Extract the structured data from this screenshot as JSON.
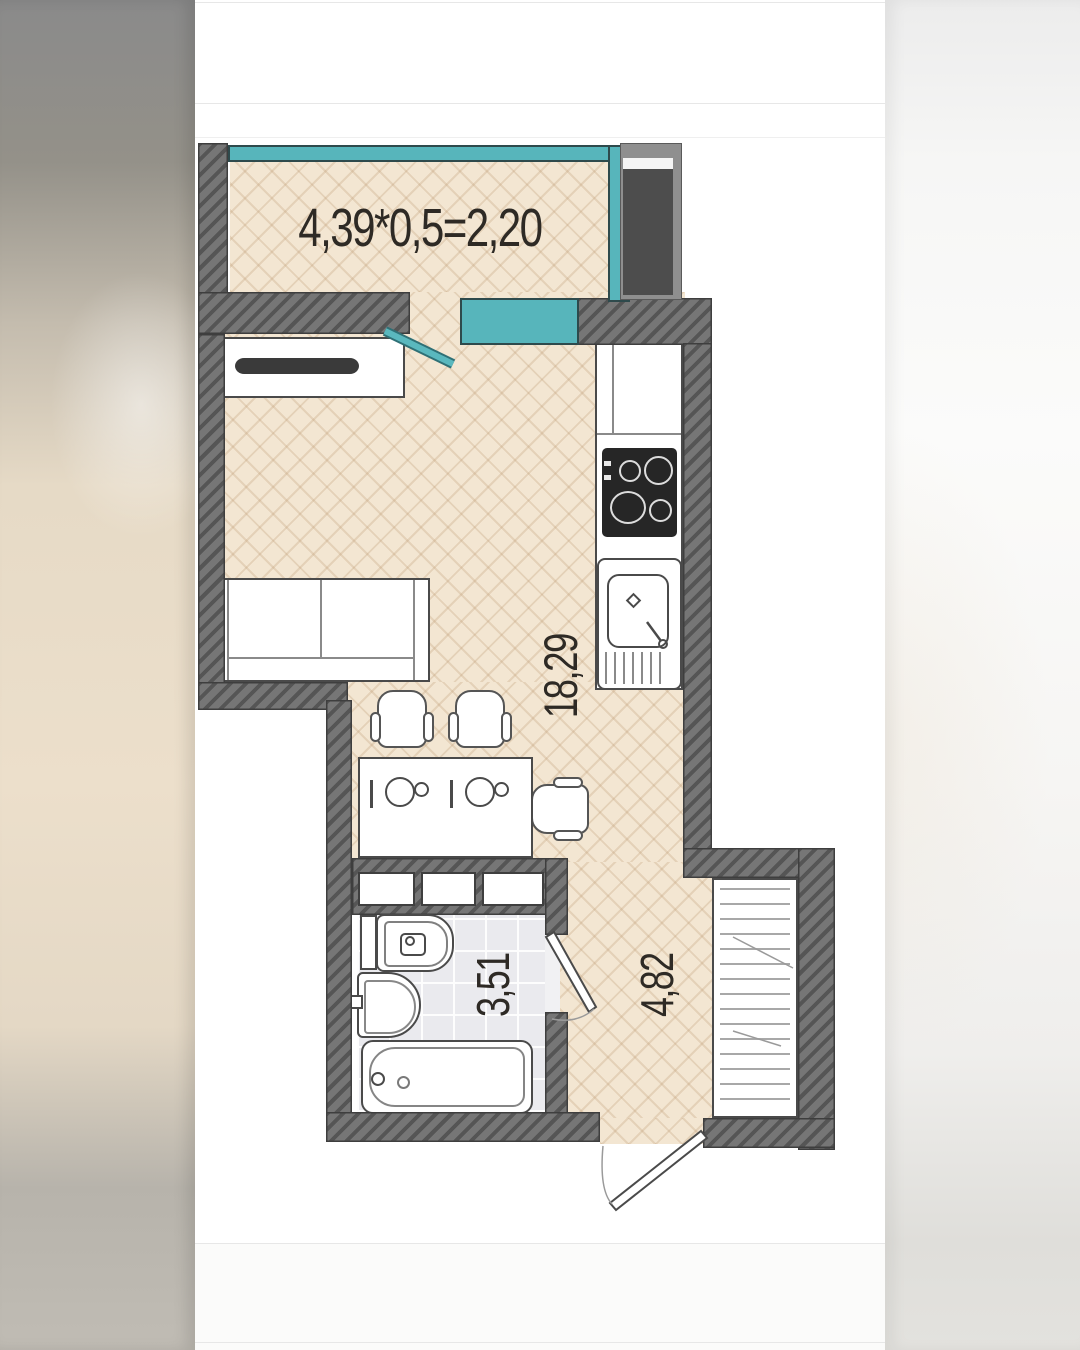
{
  "page": {
    "type": "apartment floor plan photo with blurred letterbox sides"
  },
  "plan": {
    "labels": {
      "balcony_area_formula": "4,39*0,5=2,20",
      "living_room_area": "18,29",
      "bathroom_area": "3,51",
      "hallway_area": "4,82"
    },
    "colors": {
      "wall_hatch": "#767676",
      "window_teal": "#57b5bb",
      "parquet": "#f3e6d2",
      "bathroom_tile": "#eaeaee",
      "shaft_fill": "#4d4d4d",
      "fixture_outline": "#4a4a4a",
      "label_text": "#2e2a25"
    },
    "rooms": [
      {
        "name": "balcony",
        "label": "4,39*0,5=2,20"
      },
      {
        "name": "living-room-kitchen",
        "label": "18,29"
      },
      {
        "name": "bathroom",
        "label": "3,51"
      },
      {
        "name": "hallway",
        "label": "4,82"
      }
    ],
    "fixtures": [
      "balcony-window",
      "kitchen-window",
      "ventilation-shaft",
      "tv-stand",
      "sofa",
      "dining-table",
      "chairs",
      "kitchen-counter",
      "stove",
      "kitchen-sink",
      "storage-shelves",
      "toilet",
      "washbasin",
      "bathtub",
      "wardrobe",
      "bathroom-door",
      "entrance-door",
      "balcony-door"
    ]
  }
}
